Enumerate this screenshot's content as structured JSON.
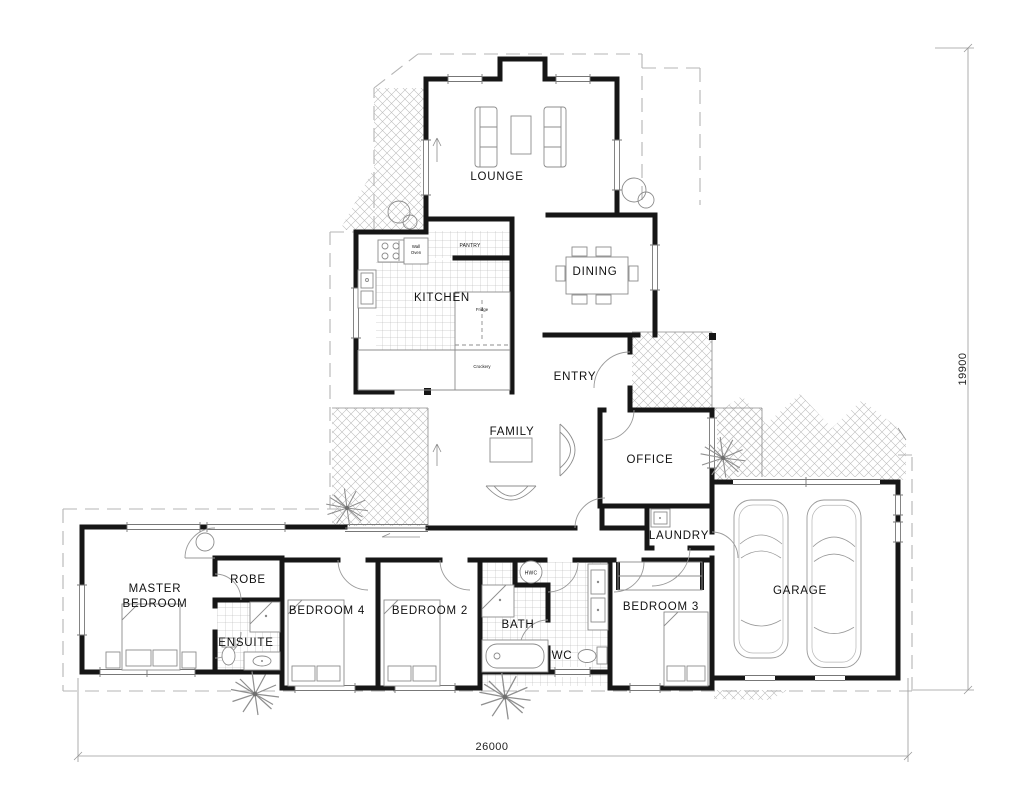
{
  "rooms": {
    "lounge": "LOUNGE",
    "dining": "DINING",
    "kitchen": "KITCHEN",
    "entry": "ENTRY",
    "family": "FAMILY",
    "office": "OFFICE",
    "laundry": "LAUNDRY",
    "master_line1": "MASTER",
    "master_line2": "BEDROOM",
    "robe": "ROBE",
    "ensuite": "ENSUITE",
    "bedroom4": "BEDROOM 4",
    "bedroom2": "BEDROOM 2",
    "bath": "BATH",
    "wc": "WC",
    "bedroom3": "BEDROOM 3",
    "garage": "GARAGE"
  },
  "labels": {
    "pantry": "PANTRY",
    "hwc": "HWC",
    "wall_oven_1": "Wall",
    "wall_oven_2": "Oven",
    "fridge": "Fridge",
    "crockery": "Crockery"
  },
  "dimensions": {
    "width": "26000",
    "height": "19900"
  },
  "colors": {
    "wall": "#161616",
    "thin_line": "#8c8c8c",
    "hatch": "#b8b8b8",
    "dashed": "#b5b5b5"
  }
}
